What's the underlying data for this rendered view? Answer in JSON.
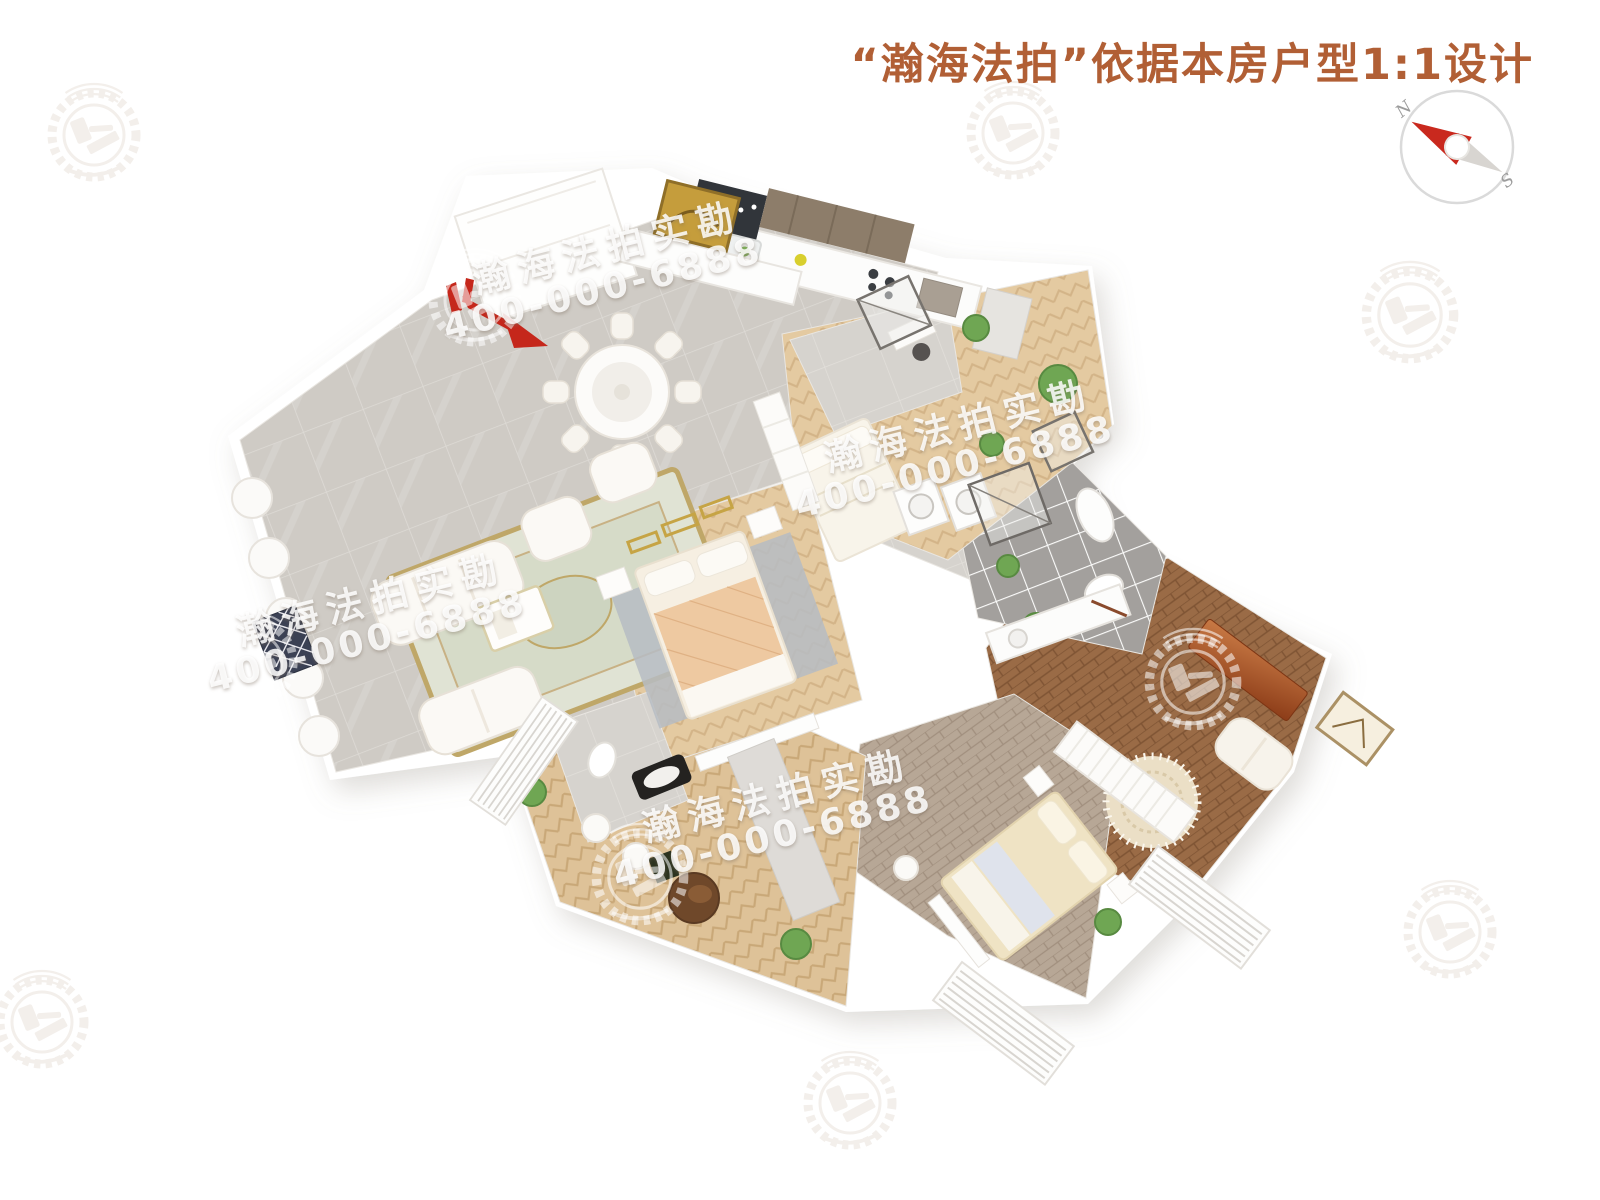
{
  "header": {
    "title": "“瀚海法拍”依据本房户型1:1设计",
    "title_color": "#b15f35"
  },
  "compass": {
    "north": "N",
    "south": "S",
    "needle_color": "#c9291e",
    "tail_color": "#d8d5d1"
  },
  "watermark": {
    "brand": "瀚海法拍实勘",
    "phone": "400-000-6888",
    "logo": "laurel-wreath-gavel-emblem",
    "text_color": "#ffffff",
    "tiled_instances": 4
  },
  "entrance": {
    "icon": "red-entry-arrow",
    "color": "#c5271b"
  },
  "floorplan": {
    "view": "top-down-3d-render-rotated",
    "rooms": {
      "living_dining_kitchen": {
        "floor_type": "gray-marble-tile",
        "floor_color": "#cfcbc5",
        "items": [
          "round-dining-table-with-8-chairs",
          "classic-white-sofa-set",
          "ornate-area-rug",
          "coffee-table",
          "sideboard-with-gold-painting",
          "kitchen-counter",
          "dark-open-shelf-cabinet",
          "wood-upper-cabinets",
          "entry-closet",
          "bay-window-curtains",
          "lattice-cabinet"
        ]
      },
      "master_bedroom": {
        "floor_type": "light-herringbone-wood",
        "floor_color": "#e4caa1",
        "items": [
          "double-bed-peach-quilt",
          "gray-rug",
          "nightstands",
          "gold-wall-decor",
          "tv-bench"
        ]
      },
      "master_bathroom": {
        "floor_type": "gray-marble-tile",
        "floor_color": "#d6d3ce",
        "items": [
          "toilet",
          "black-bathtub"
        ]
      },
      "bedroom_2": {
        "floor_type": "light-herringbone-wood",
        "floor_color": "#e4caa1",
        "items": [
          "bed",
          "wardrobe",
          "desk-and-chair",
          "glass-shower",
          "marble-wet-area",
          "potted-plants"
        ]
      },
      "bathroom_dark": {
        "floor_type": "dark-gray-square-tile",
        "floor_color": "#a3a09d",
        "items": [
          "glass-shower",
          "toilet",
          "bathtub",
          "long-vanity"
        ]
      },
      "laundry_corridor": {
        "floor_type": "gray-marble-tile",
        "floor_color": "#d6d3ce",
        "items": [
          "washer",
          "dryer"
        ]
      },
      "family_room_right": {
        "floor_type": "brown-plank-wood",
        "floor_color": "#9a6b46",
        "items": [
          "redwood-console",
          "lounge-sofa",
          "round-woven-rug",
          "leaning-picture-frame",
          "potted-plant"
        ]
      },
      "bedroom_3": {
        "floor_type": "greige-plank-wood",
        "floor_color": "#b7a796",
        "items": [
          "cream-bed",
          "nightstands",
          "foot-bench",
          "wardrobe-row",
          "louver-blinds",
          "potted-plant",
          "stool"
        ]
      },
      "bedroom_4_bottom_left": {
        "floor_type": "light-herringbone-parquet",
        "floor_color": "#dec298",
        "items": [
          "louver-blinds",
          "potted-plants",
          "round-leather-ottoman",
          "white-stools",
          "dark-planter"
        ]
      }
    }
  }
}
